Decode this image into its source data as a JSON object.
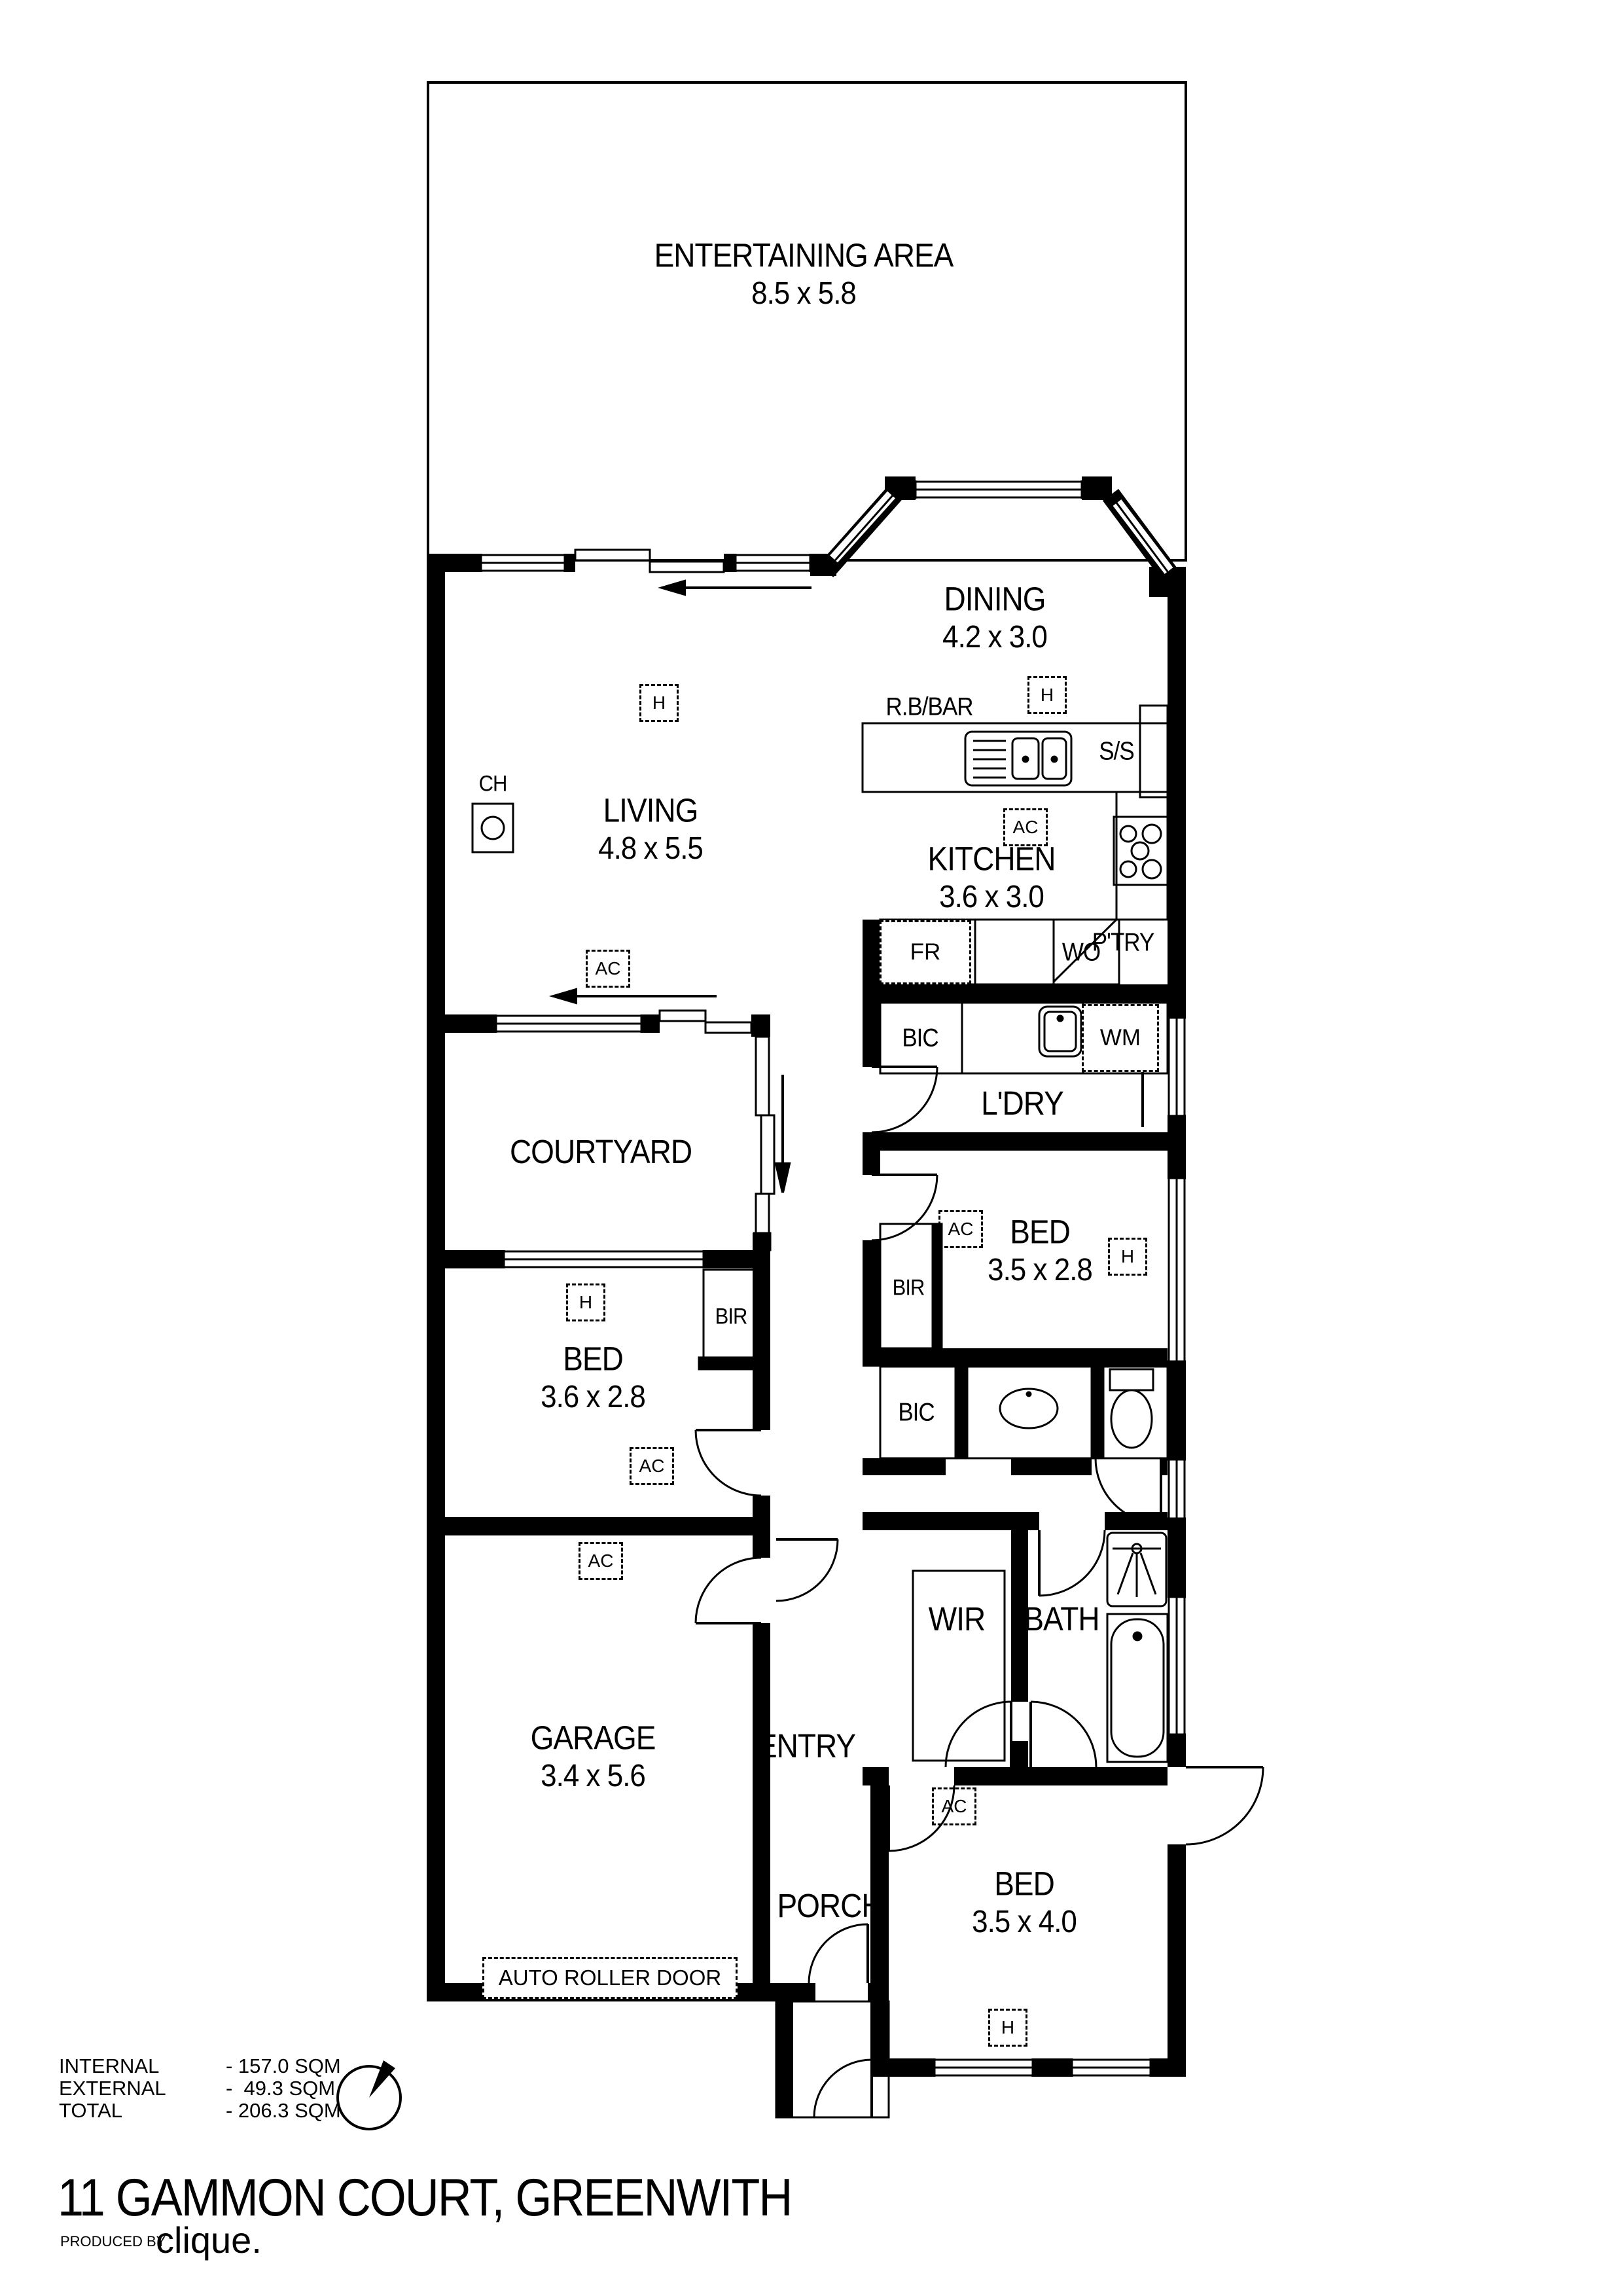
{
  "rooms": {
    "entertaining": {
      "name": "ENTERTAINING AREA",
      "dims": "8.5 x 5.8"
    },
    "dining": {
      "name": "DINING",
      "dims": "4.2 x 3.0"
    },
    "living": {
      "name": "LIVING",
      "dims": "4.8 x 5.5"
    },
    "kitchen": {
      "name": "KITCHEN",
      "dims": "3.6 x 3.0"
    },
    "laundry": {
      "name": "L'DRY"
    },
    "courtyard": {
      "name": "COURTYARD"
    },
    "bed2": {
      "name": "BED",
      "dims": "3.5 x 2.8"
    },
    "bed3": {
      "name": "BED",
      "dims": "3.6 x 2.8"
    },
    "bed4": {
      "name": "BED",
      "dims": "3.5 x 4.0"
    },
    "garage": {
      "name": "GARAGE",
      "dims": "3.4 x 5.6"
    },
    "wir": {
      "name": "WIR"
    },
    "bath": {
      "name": "BATH"
    },
    "entry": {
      "name": "ENTRY"
    },
    "porch": {
      "name": "PORCH"
    }
  },
  "fixtures": {
    "rbbar": "R.B/BAR",
    "ss": "S/S",
    "fridge": "FR",
    "wall_oven": "WO",
    "pantry": "P'TRY",
    "bic": "BIC",
    "wm": "WM",
    "bir": "BIR",
    "ch": "CH",
    "auto_roller_door": "AUTO ROLLER DOOR"
  },
  "symbols": {
    "heating": "H",
    "aircon": "AC"
  },
  "areas": {
    "rows": [
      {
        "label": "INTERNAL",
        "value": "- 157.0 SQM"
      },
      {
        "label": "EXTERNAL",
        "value": "-  49.3 SQM"
      },
      {
        "label": "TOTAL",
        "value": "- 206.3 SQM"
      }
    ]
  },
  "footer": {
    "address": "11 GAMMON COURT, GREENWITH",
    "produced_by": "PRODUCED BY",
    "brand": "clique."
  }
}
